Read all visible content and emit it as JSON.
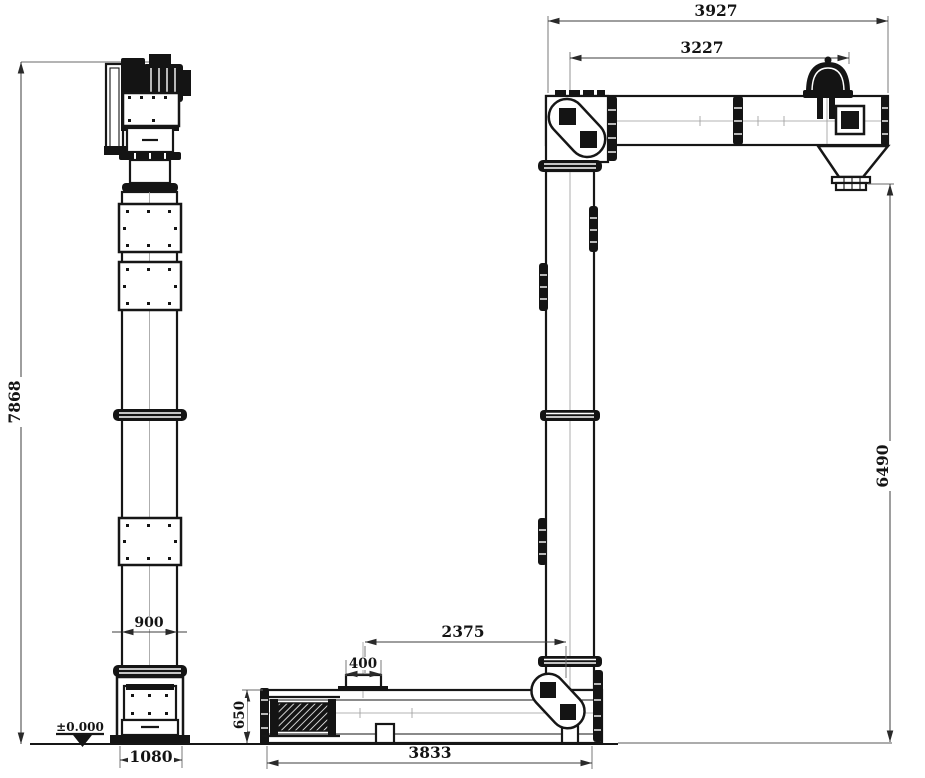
{
  "drawing": {
    "kind": "elevation general-arrangement drawing: bucket elevator (left) and Z-type chain conveyor (right)",
    "colors": {
      "line": "#161616",
      "dim_line": "#3c3c3c",
      "background": "#ffffff"
    },
    "dims": {
      "overall_height": "7868",
      "casing_width": "900",
      "boot_width": "1080",
      "ground_level": "±0.000",
      "top_overall_length": "3927",
      "top_inner_length": "3227",
      "discharge_height": "6490",
      "inlet_to_tail_center": "2375",
      "inlet_width": "400",
      "trough_height": "650",
      "bottom_overall_length": "3833"
    }
  }
}
